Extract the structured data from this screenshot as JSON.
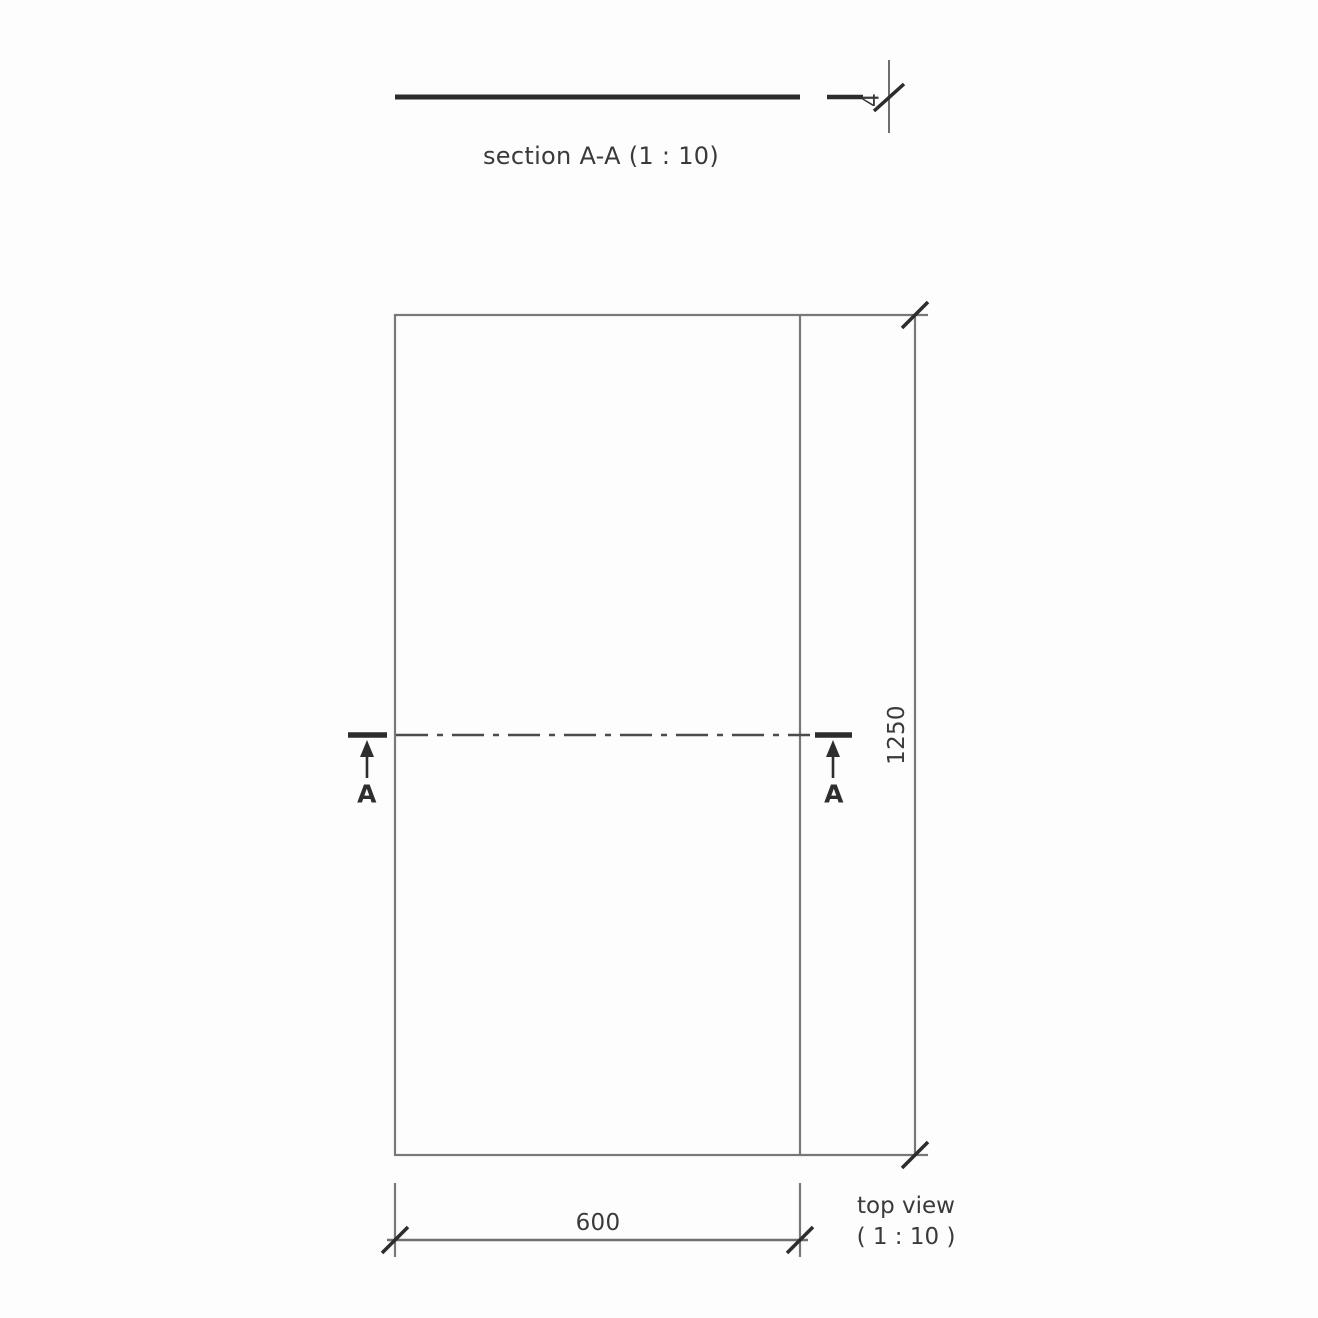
{
  "drawing": {
    "section_view": {
      "title": "section A-A (1 : 10)",
      "thickness_label": "4"
    },
    "top_view": {
      "width_label": "600",
      "height_label": "1250",
      "cut_marker_left": "A",
      "cut_marker_right": "A",
      "caption_line1": "top view",
      "caption_line2": "( 1 : 10 )"
    },
    "colors": {
      "background": "#fdfdfd",
      "outline_gray": "#787878",
      "dark_line": "#2d2d2d",
      "centerline": "#4c4c4c",
      "text": "#3a3a3a"
    }
  }
}
